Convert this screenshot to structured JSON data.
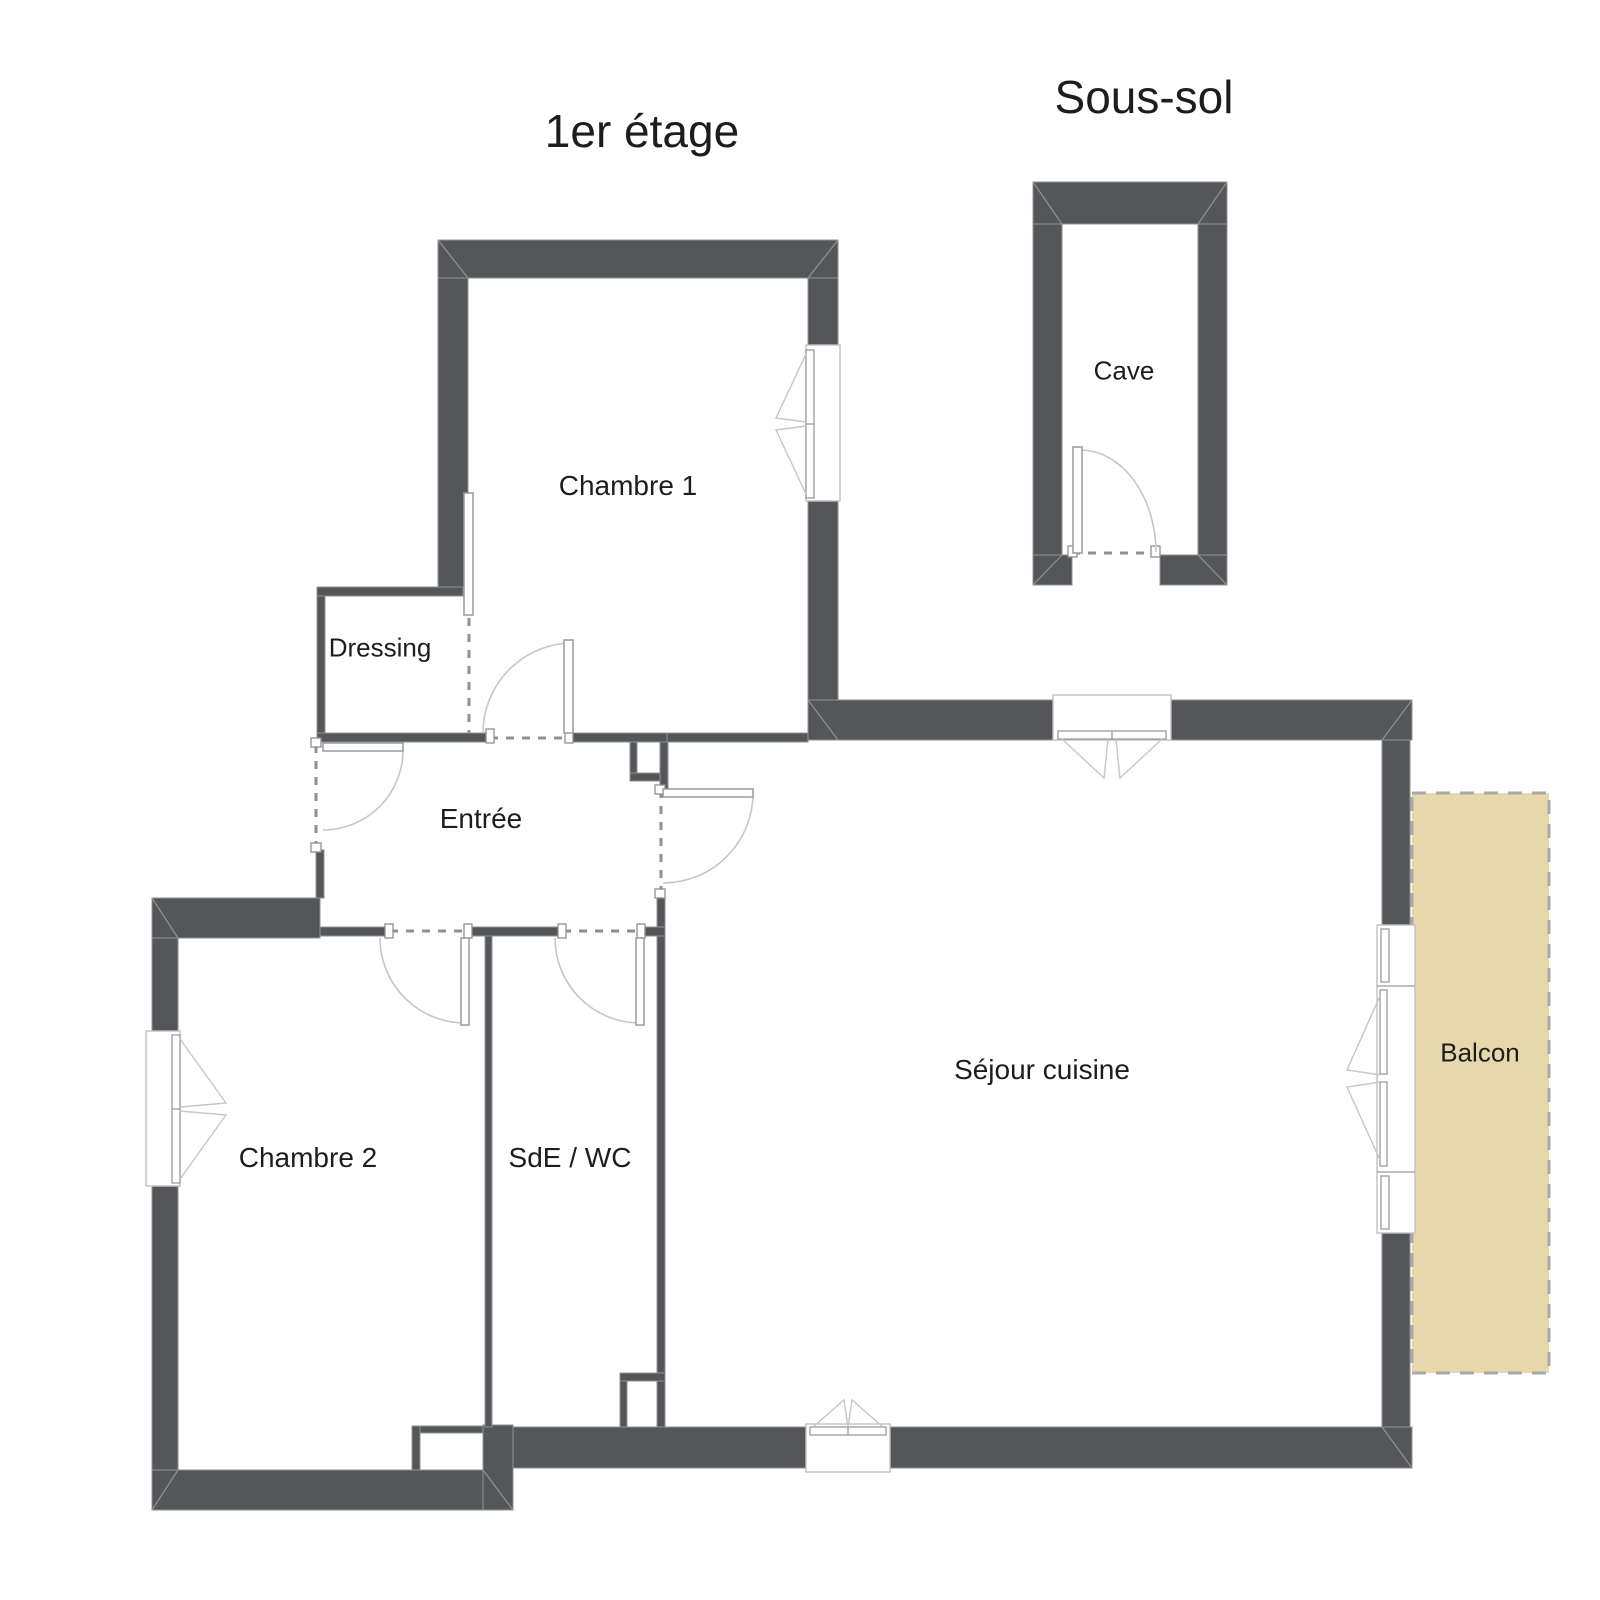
{
  "titles": {
    "floor": "1er étage",
    "basement": "Sous-sol"
  },
  "rooms": [
    {
      "name": "Chambre 1"
    },
    {
      "name": "Dressing"
    },
    {
      "name": "Entrée"
    },
    {
      "name": "Chambre 2"
    },
    {
      "name": "SdE / WC"
    },
    {
      "name": "Séjour cuisine"
    },
    {
      "name": "Balcon"
    },
    {
      "name": "Cave"
    }
  ],
  "colors": {
    "background": "#ffffff",
    "wall": "#545659",
    "wall_outline": "#8f9193",
    "dash": "#8f8f8f",
    "door_line": "#c6c6c6",
    "balcony_fill": "#e7d8ac",
    "balcony_border": "#a9a9a9",
    "text": "#1d1d1d"
  }
}
